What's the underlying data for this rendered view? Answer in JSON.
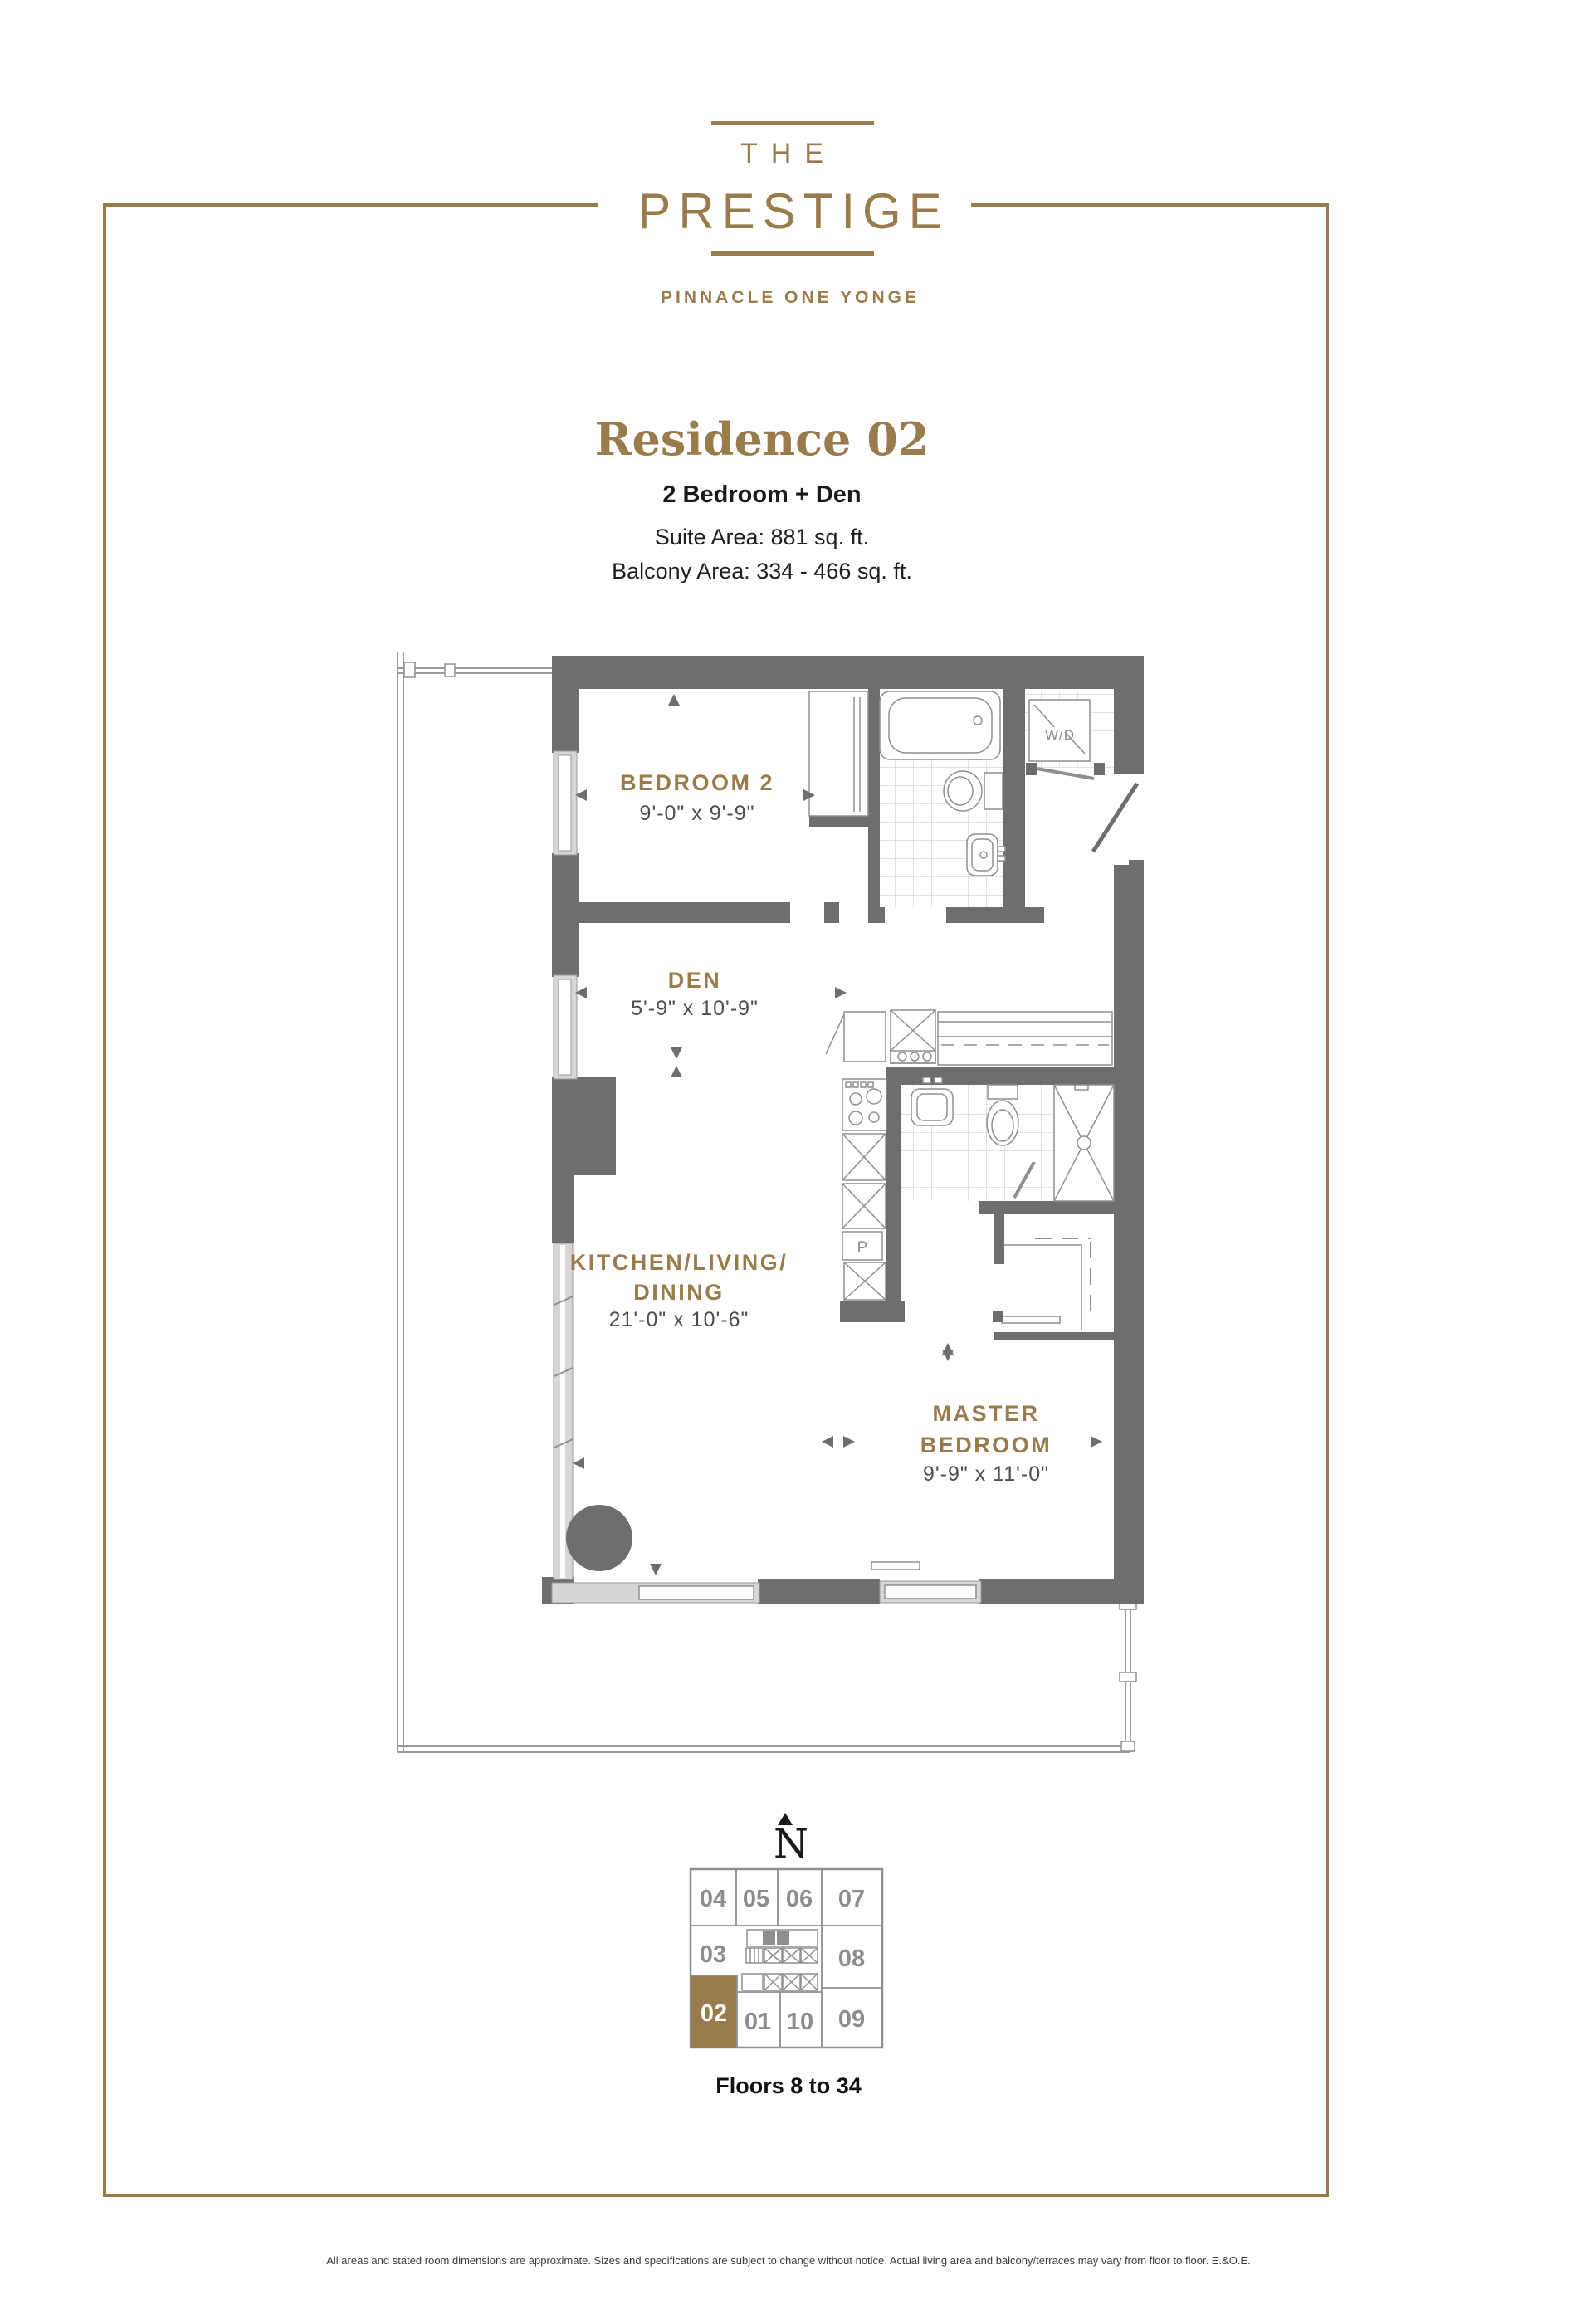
{
  "logo": {
    "line1": "THE",
    "line2": "PRESTIGE",
    "tagline": "PINNACLE ONE YONGE"
  },
  "title": {
    "residence": "Residence 02",
    "suite_type": "2 Bedroom + Den",
    "suite_area": "Suite Area: 881 sq. ft.",
    "balcony_area": "Balcony Area: 334 - 466 sq. ft."
  },
  "plan": {
    "bedroom2": {
      "name": "BEDROOM 2",
      "dims": "9'-0\" x 9'-9\""
    },
    "den": {
      "name": "DEN",
      "dims": "5'-9\" x 10'-9\""
    },
    "kitchen": {
      "name_line1": "KITCHEN/LIVING/",
      "name_line2": "DINING",
      "dims": "21'-0\" x 10'-6\""
    },
    "master": {
      "name_line1": "MASTER",
      "name_line2": "BEDROOM",
      "dims": "9'-9\" x 11'-0\""
    },
    "fixtures": {
      "washer_dryer": "W/D",
      "pantry": "P"
    }
  },
  "north_letter": "N",
  "keyplan": {
    "units": [
      "04",
      "05",
      "06",
      "07",
      "03",
      "08",
      "02",
      "01",
      "10",
      "09"
    ],
    "highlighted_unit": "02",
    "floors_label": "Floors 8 to 34"
  },
  "footer": {
    "disclaimer": "All areas and stated room dimensions are approximate. Sizes and specifications are subject to change without notice. Actual living area and balcony/terraces may vary from floor to floor. E.&O.E."
  },
  "colors": {
    "gold": "#9a7c4c",
    "wall_gray": "#6e6e70",
    "window_band": "#d6d6d8",
    "key_gray": "#8d8d8f"
  }
}
